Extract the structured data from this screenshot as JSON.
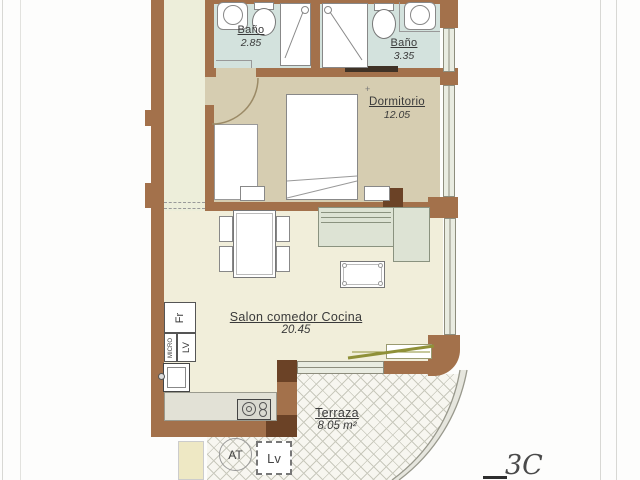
{
  "plan": {
    "code": "3C",
    "survey_mark": "+"
  },
  "rooms": {
    "bano1": {
      "name": "Baño",
      "area": "2.85"
    },
    "bano2": {
      "name": "Baño",
      "area": "3.35"
    },
    "dormitorio": {
      "name": "Dormitorio",
      "area": "12.05"
    },
    "salon": {
      "name": "Salon comedor Cocina",
      "area": "20.45"
    },
    "terraza": {
      "name": "Terraza",
      "area": "8.05 m²"
    }
  },
  "appliances": {
    "fridge": "Fr",
    "microwave": "MICRO",
    "dishwasher": "LV",
    "water_heater": "AT",
    "washing_machine": "Lv"
  },
  "colors": {
    "wall": "#a3714b",
    "wall_dark": "#6b4226",
    "bathroom_floor": "#d3e2dd",
    "bedroom_floor": "#d6cdb1",
    "living_floor": "#f1eeda",
    "hall_floor": "#edeeda",
    "sofa": "#dde3d4",
    "terrace_door": "#8f9038"
  }
}
